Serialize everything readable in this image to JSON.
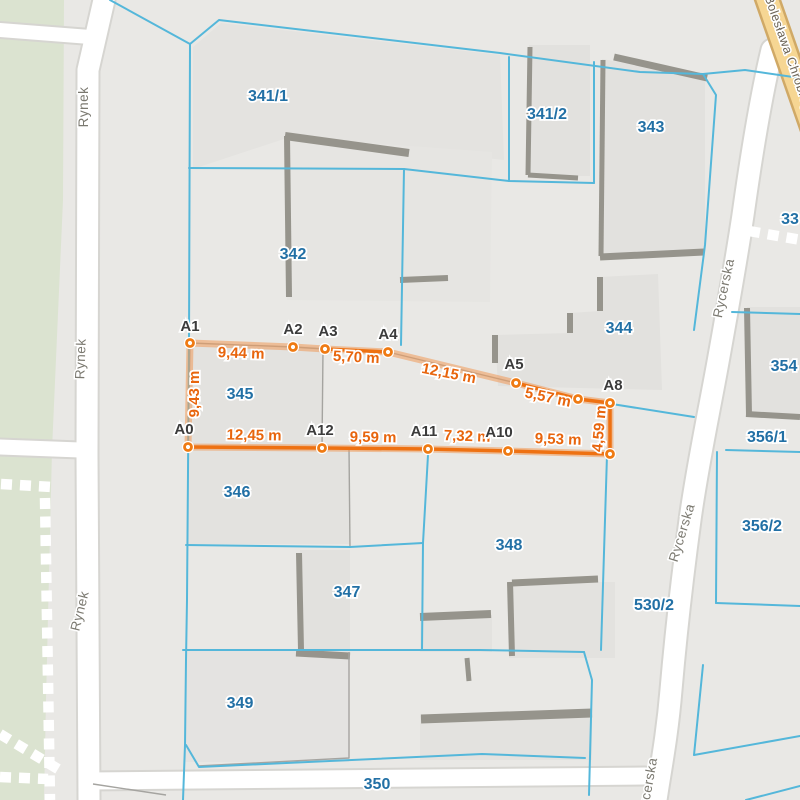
{
  "map": {
    "colors": {
      "background": "#e9e8e5",
      "green_area": "#dbe3d0",
      "parcel_line": "#54b7da",
      "parcel_label": "#2270a5",
      "street_label": "#7b7970",
      "road_fill": "#ffffff",
      "road_casing": "#d6d5d1",
      "main_road_fill": "#f6d693",
      "main_road_casing": "#d0a966",
      "building_fill": "#e2e1de",
      "building_edge": "#96948c",
      "measure_vivid": "#ee7112",
      "measure_pale": "rgba(240,153,88,0.55)",
      "measure_label": "#e8650d",
      "vertex_label": "#3b3b3b"
    },
    "parcel_labels": [
      {
        "text": "341/1",
        "x": 268,
        "y": 101
      },
      {
        "text": "341/2",
        "x": 547,
        "y": 119
      },
      {
        "text": "343",
        "x": 651,
        "y": 132
      },
      {
        "text": "342",
        "x": 293,
        "y": 259
      },
      {
        "text": "344",
        "x": 619,
        "y": 333
      },
      {
        "text": "354",
        "x": 784,
        "y": 371
      },
      {
        "text": "345",
        "x": 240,
        "y": 399
      },
      {
        "text": "356/1",
        "x": 767,
        "y": 442
      },
      {
        "text": "346",
        "x": 237,
        "y": 497
      },
      {
        "text": "356/2",
        "x": 762,
        "y": 531
      },
      {
        "text": "348",
        "x": 509,
        "y": 550
      },
      {
        "text": "347",
        "x": 347,
        "y": 597
      },
      {
        "text": "530/2",
        "x": 654,
        "y": 610
      },
      {
        "text": "349",
        "x": 240,
        "y": 708
      },
      {
        "text": "350",
        "x": 377,
        "y": 789
      },
      {
        "text": "33",
        "x": 790,
        "y": 224
      }
    ],
    "street_labels": [
      {
        "text": "Rynek",
        "x": 88,
        "y": 107,
        "rotate": -90,
        "main": false
      },
      {
        "text": "Rynek",
        "x": 85,
        "y": 359,
        "rotate": -88,
        "main": false
      },
      {
        "text": "Rynek",
        "x": 84,
        "y": 612,
        "rotate": -76,
        "main": false
      },
      {
        "text": "Rycerska",
        "x": 728,
        "y": 289,
        "rotate": -78,
        "main": false
      },
      {
        "text": "Rycerska",
        "x": 686,
        "y": 534,
        "rotate": -73,
        "main": false
      },
      {
        "text": "Rycerska",
        "x": 652,
        "y": 788,
        "rotate": -80,
        "main": false
      },
      {
        "text": "Bolesława Chrobrego",
        "x": 786,
        "y": 58,
        "rotate": 70.5,
        "main": true
      }
    ],
    "measurement": {
      "points": [
        {
          "name": "A0",
          "x": 188,
          "y": 447,
          "lx": 184,
          "ly": 434
        },
        {
          "name": "A1",
          "x": 190,
          "y": 343,
          "lx": 190,
          "ly": 331
        },
        {
          "name": "A2",
          "x": 293,
          "y": 347,
          "lx": 293,
          "ly": 334
        },
        {
          "name": "A3",
          "x": 325,
          "y": 349,
          "lx": 328,
          "ly": 336
        },
        {
          "name": "A4",
          "x": 388,
          "y": 352,
          "lx": 388,
          "ly": 339
        },
        {
          "name": "A5",
          "x": 516,
          "y": 383,
          "lx": 514,
          "ly": 369
        },
        {
          "name": "",
          "x": 578,
          "y": 399,
          "lx": 0,
          "ly": 0
        },
        {
          "name": "A8",
          "x": 610,
          "y": 403,
          "lx": 613,
          "ly": 390
        },
        {
          "name": "",
          "x": 610,
          "y": 454,
          "lx": 0,
          "ly": 0
        },
        {
          "name": "A10",
          "x": 508,
          "y": 451,
          "lx": 499,
          "ly": 437
        },
        {
          "name": "A11",
          "x": 428,
          "y": 449,
          "lx": 424,
          "ly": 436
        },
        {
          "name": "A12",
          "x": 322,
          "y": 448,
          "lx": 320,
          "ly": 435
        }
      ],
      "vivid_segments": [
        [
          3,
          4
        ],
        [
          5,
          6
        ],
        [
          6,
          7
        ],
        [
          7,
          8
        ],
        [
          8,
          9
        ],
        [
          9,
          10
        ],
        [
          10,
          11
        ],
        [
          11,
          0
        ]
      ],
      "distance_labels": [
        {
          "text": "9,43 m",
          "x": 199,
          "y": 394,
          "rotate": -90
        },
        {
          "text": "9,44 m",
          "x": 241,
          "y": 358,
          "rotate": 2
        },
        {
          "text": "5,70 m",
          "x": 356,
          "y": 362,
          "rotate": 3
        },
        {
          "text": "12,15 m",
          "x": 448,
          "y": 378,
          "rotate": 11
        },
        {
          "text": "5,57 m",
          "x": 547,
          "y": 402,
          "rotate": 12
        },
        {
          "text": "4,59 m",
          "x": 604,
          "y": 429,
          "rotate": -85
        },
        {
          "text": "9,53 m",
          "x": 558,
          "y": 444,
          "rotate": 2
        },
        {
          "text": "7,32 m",
          "x": 467,
          "y": 441,
          "rotate": 2
        },
        {
          "text": "9,59 m",
          "x": 373,
          "y": 442,
          "rotate": 1
        },
        {
          "text": "12,45 m",
          "x": 254,
          "y": 440,
          "rotate": 1
        }
      ]
    }
  }
}
